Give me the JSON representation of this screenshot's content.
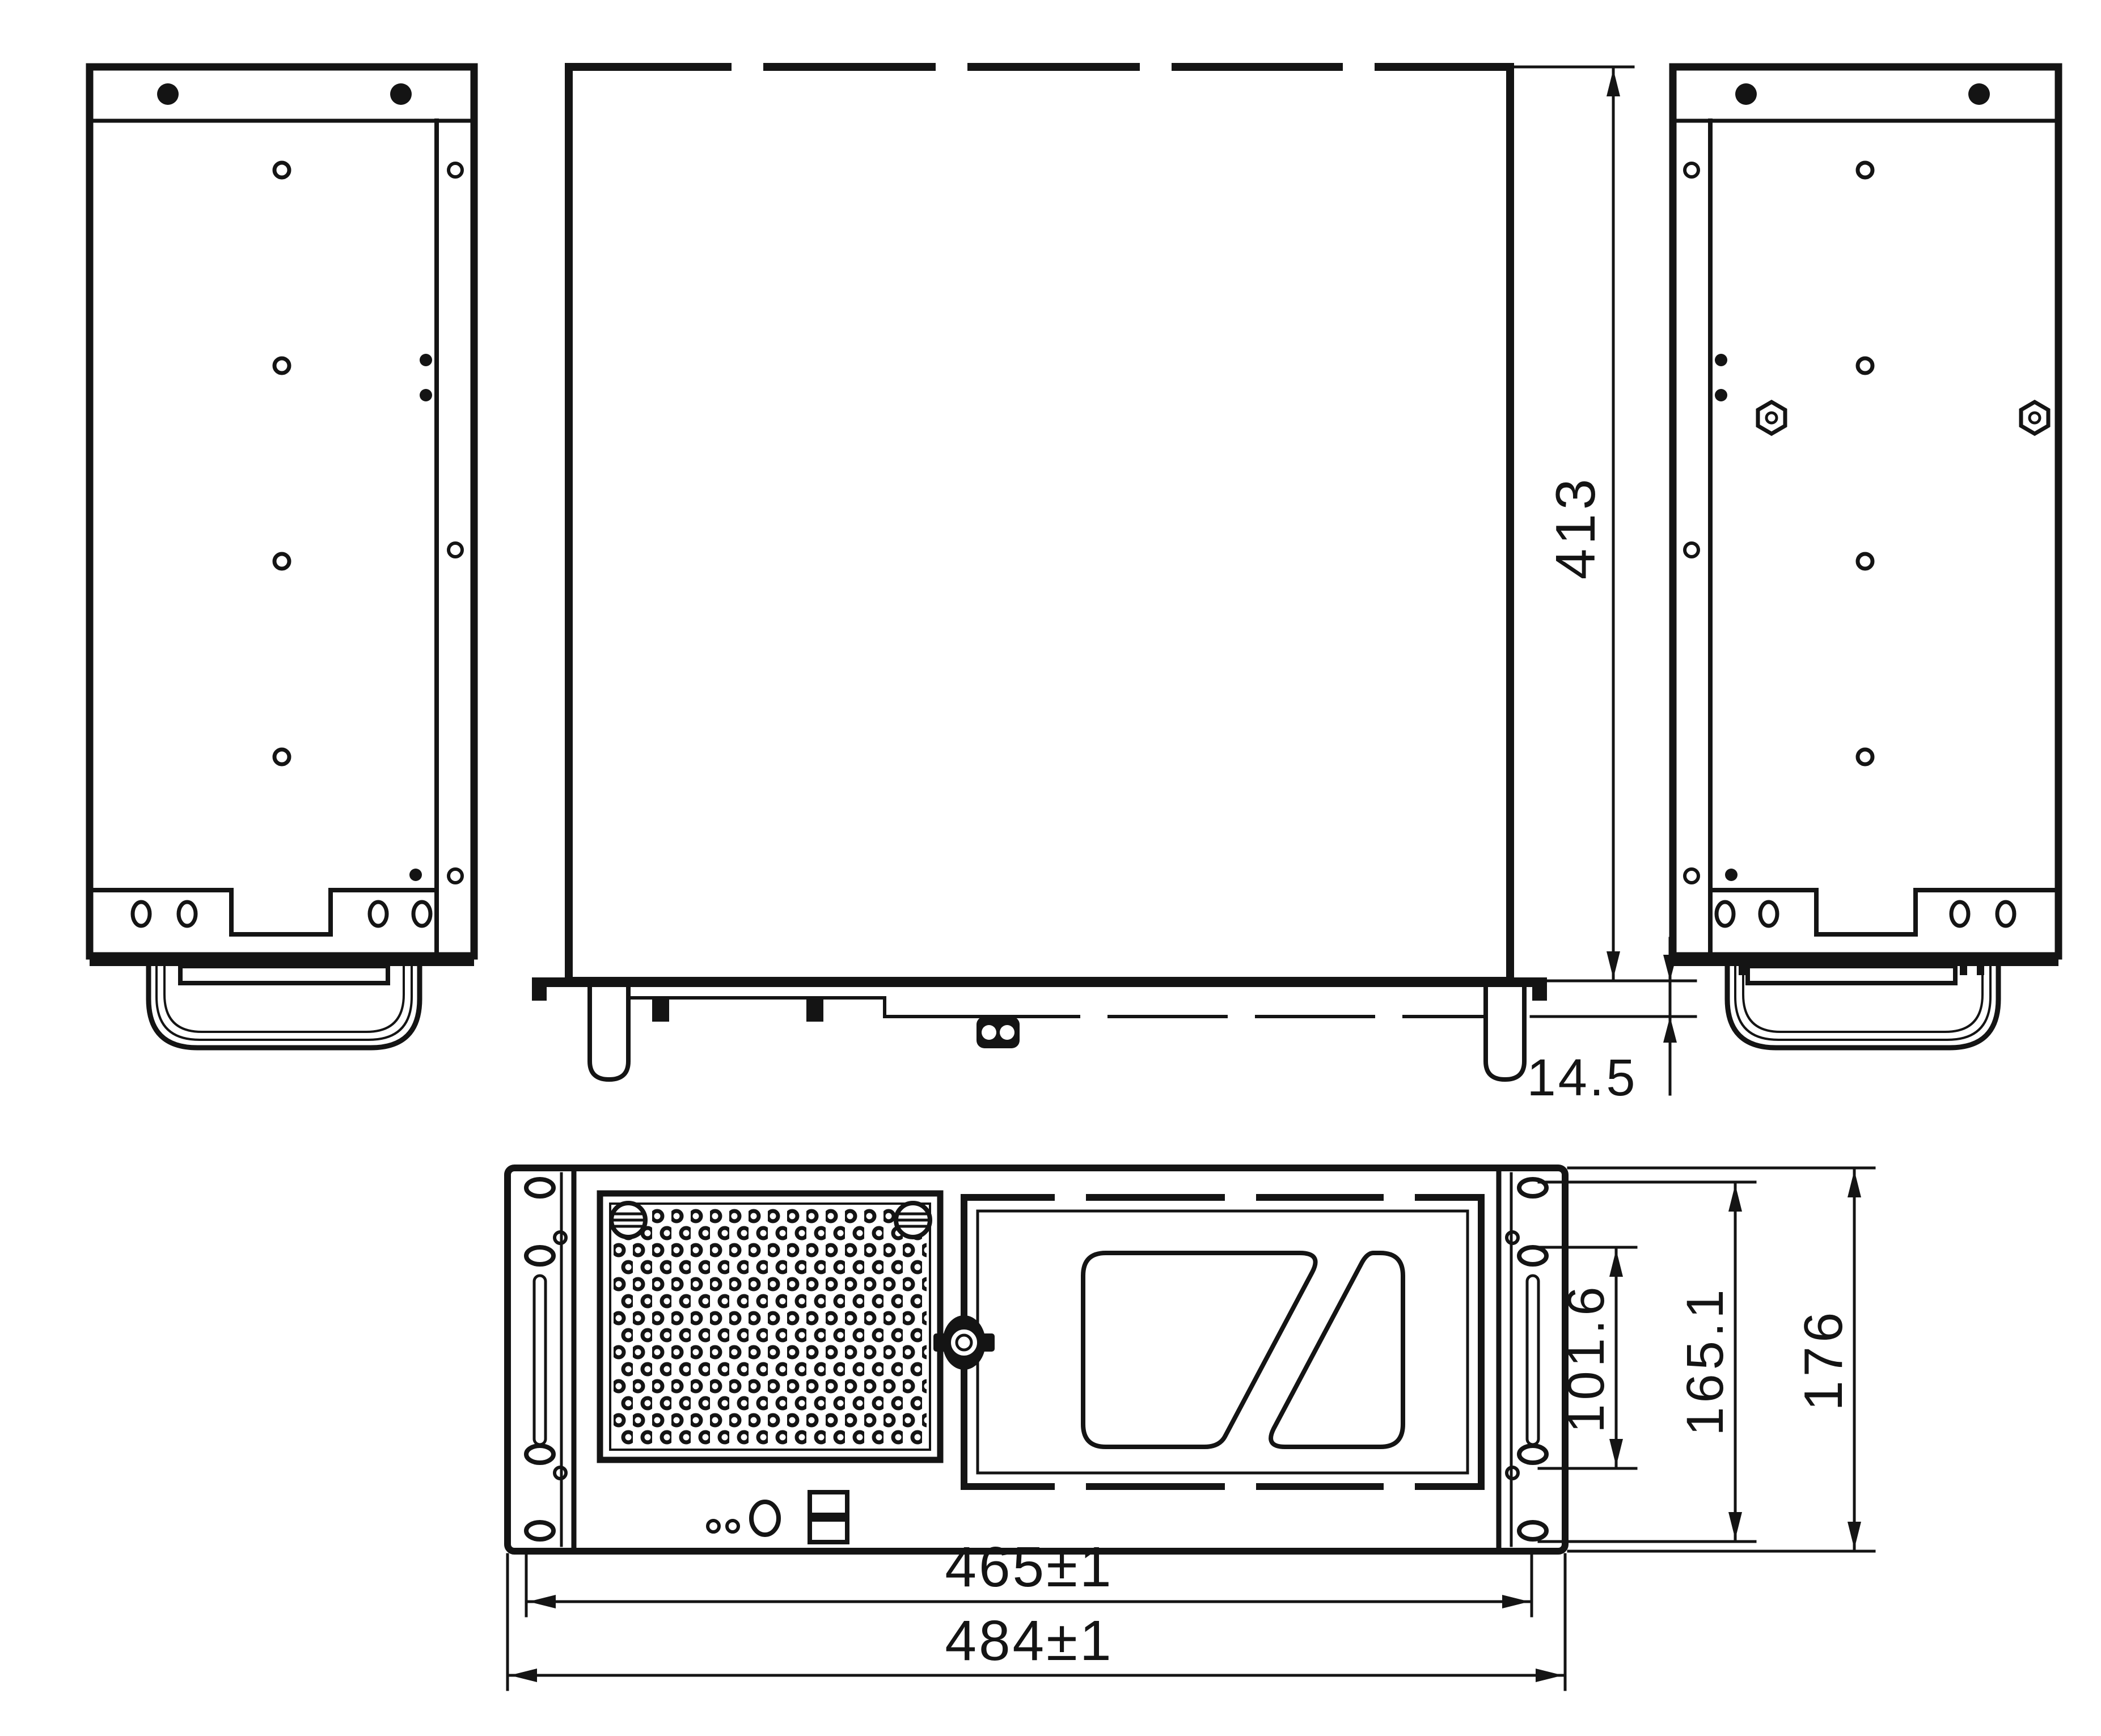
{
  "drawing": {
    "type": "engineering-dimension-drawing",
    "subject": "4U rackmount chassis",
    "dimensions": {
      "top_view_depth": "413",
      "front_lip_offset": "14.5",
      "mount_hole_span_inner": "101.6",
      "mount_hole_span_outer": "165.1",
      "front_panel_height": "176",
      "body_width": "465±1",
      "overall_width": "484±1"
    },
    "colors": {
      "line": "#141414",
      "background": "#ffffff"
    }
  }
}
